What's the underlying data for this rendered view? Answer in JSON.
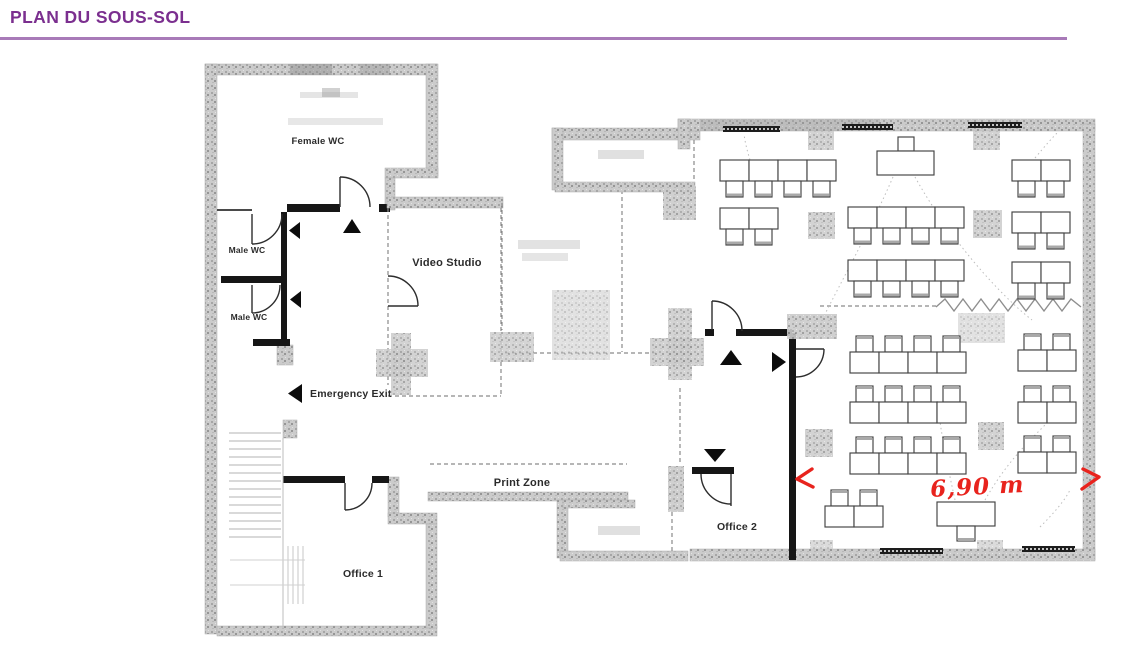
{
  "header": {
    "title": "PLAN DU SOUS-SOL",
    "title_color": "#7b2f8f",
    "rule_color": "#a87ab8"
  },
  "floorplan": {
    "rooms": {
      "female_wc": "Female WC",
      "male_wc_1": "Male WC",
      "male_wc_2": "Male WC",
      "video_studio": "Video Studio",
      "office_1": "Office 1",
      "office_2": "Office 2"
    },
    "zones": {
      "emergency_exit": "Emergency Exit",
      "print_zone": "Print Zone"
    },
    "annotation": {
      "dimension": "6,90 m",
      "color": "#e8231d"
    }
  }
}
